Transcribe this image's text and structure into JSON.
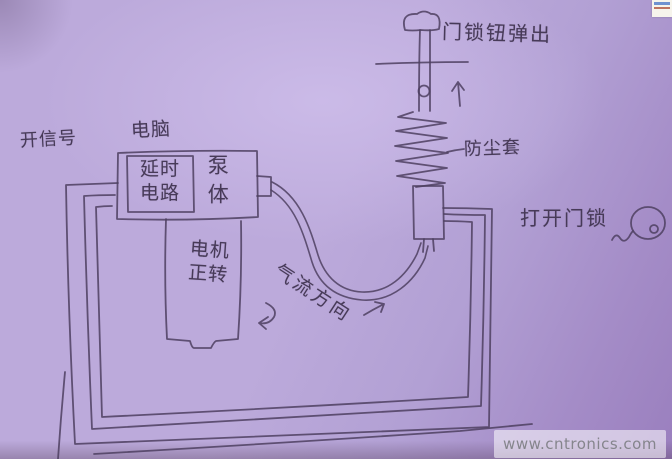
{
  "labels": {
    "open_signal": "开信号",
    "computer": "电脑",
    "delay_line1": "延时",
    "delay_line2": "电路",
    "pump_body": "泵体",
    "motor_line1": "电机",
    "motor_line2": "正转",
    "lock_knob_pop": "门锁钮弹出",
    "dust_cover": "防尘套",
    "open_door_lock": "打开门锁",
    "airflow_direction": "气流方向"
  },
  "watermark": {
    "text": "www.cntronics.com"
  },
  "colors": {
    "paper": "#b7a5d8",
    "pencil_ink": "#4d3f60",
    "watermark_text": "#85858c",
    "watermark_bg": "rgba(255,255,255,0.55)"
  }
}
